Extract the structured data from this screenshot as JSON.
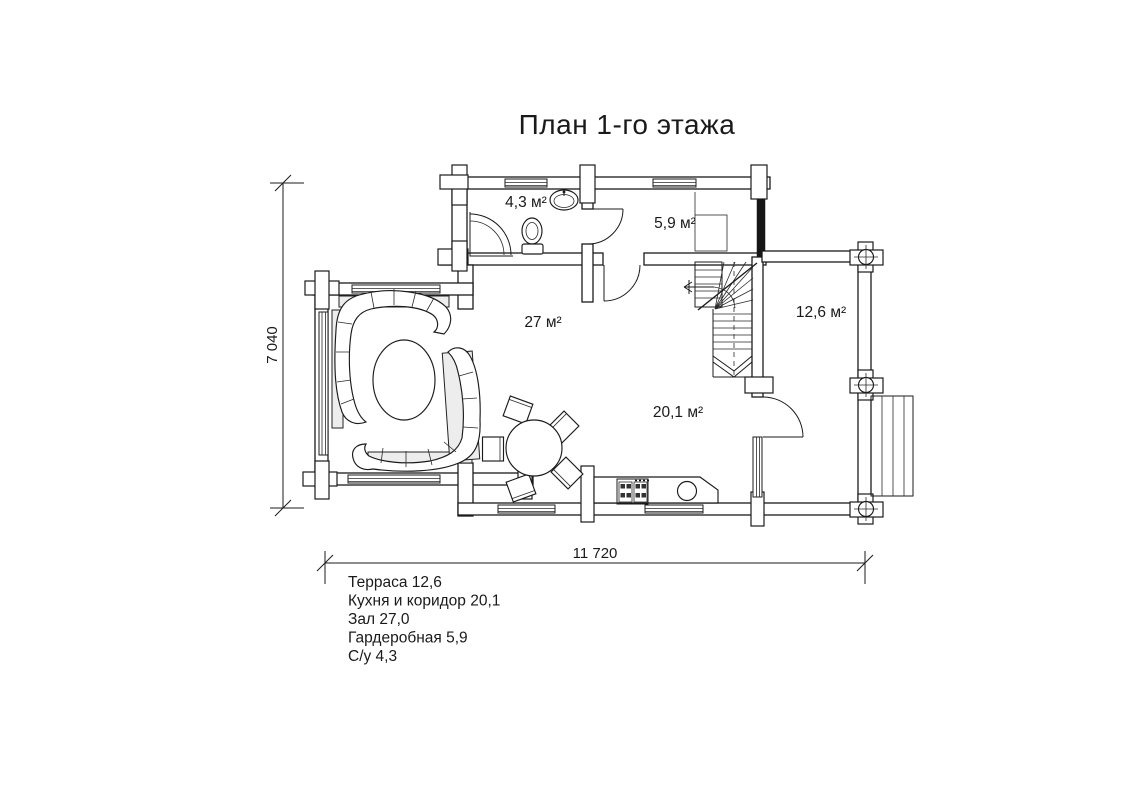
{
  "title": "План 1-го этажа",
  "room_labels": {
    "bathroom": "4,3 м²",
    "wardrobe": "5,9 м²",
    "living": "27 м²",
    "terrace": "12,6 м²",
    "kitchen": "20,1 м²"
  },
  "dimensions": {
    "horizontal": "11 720",
    "vertical": "7 040"
  },
  "legend": [
    "Терраса 12,6",
    "Кухня и коридор 20,1",
    "Зал 27,0",
    "Гардеробная 5,9",
    "С/у 4,3"
  ],
  "colors": {
    "line": "#1b1b1b",
    "background": "#ffffff"
  }
}
